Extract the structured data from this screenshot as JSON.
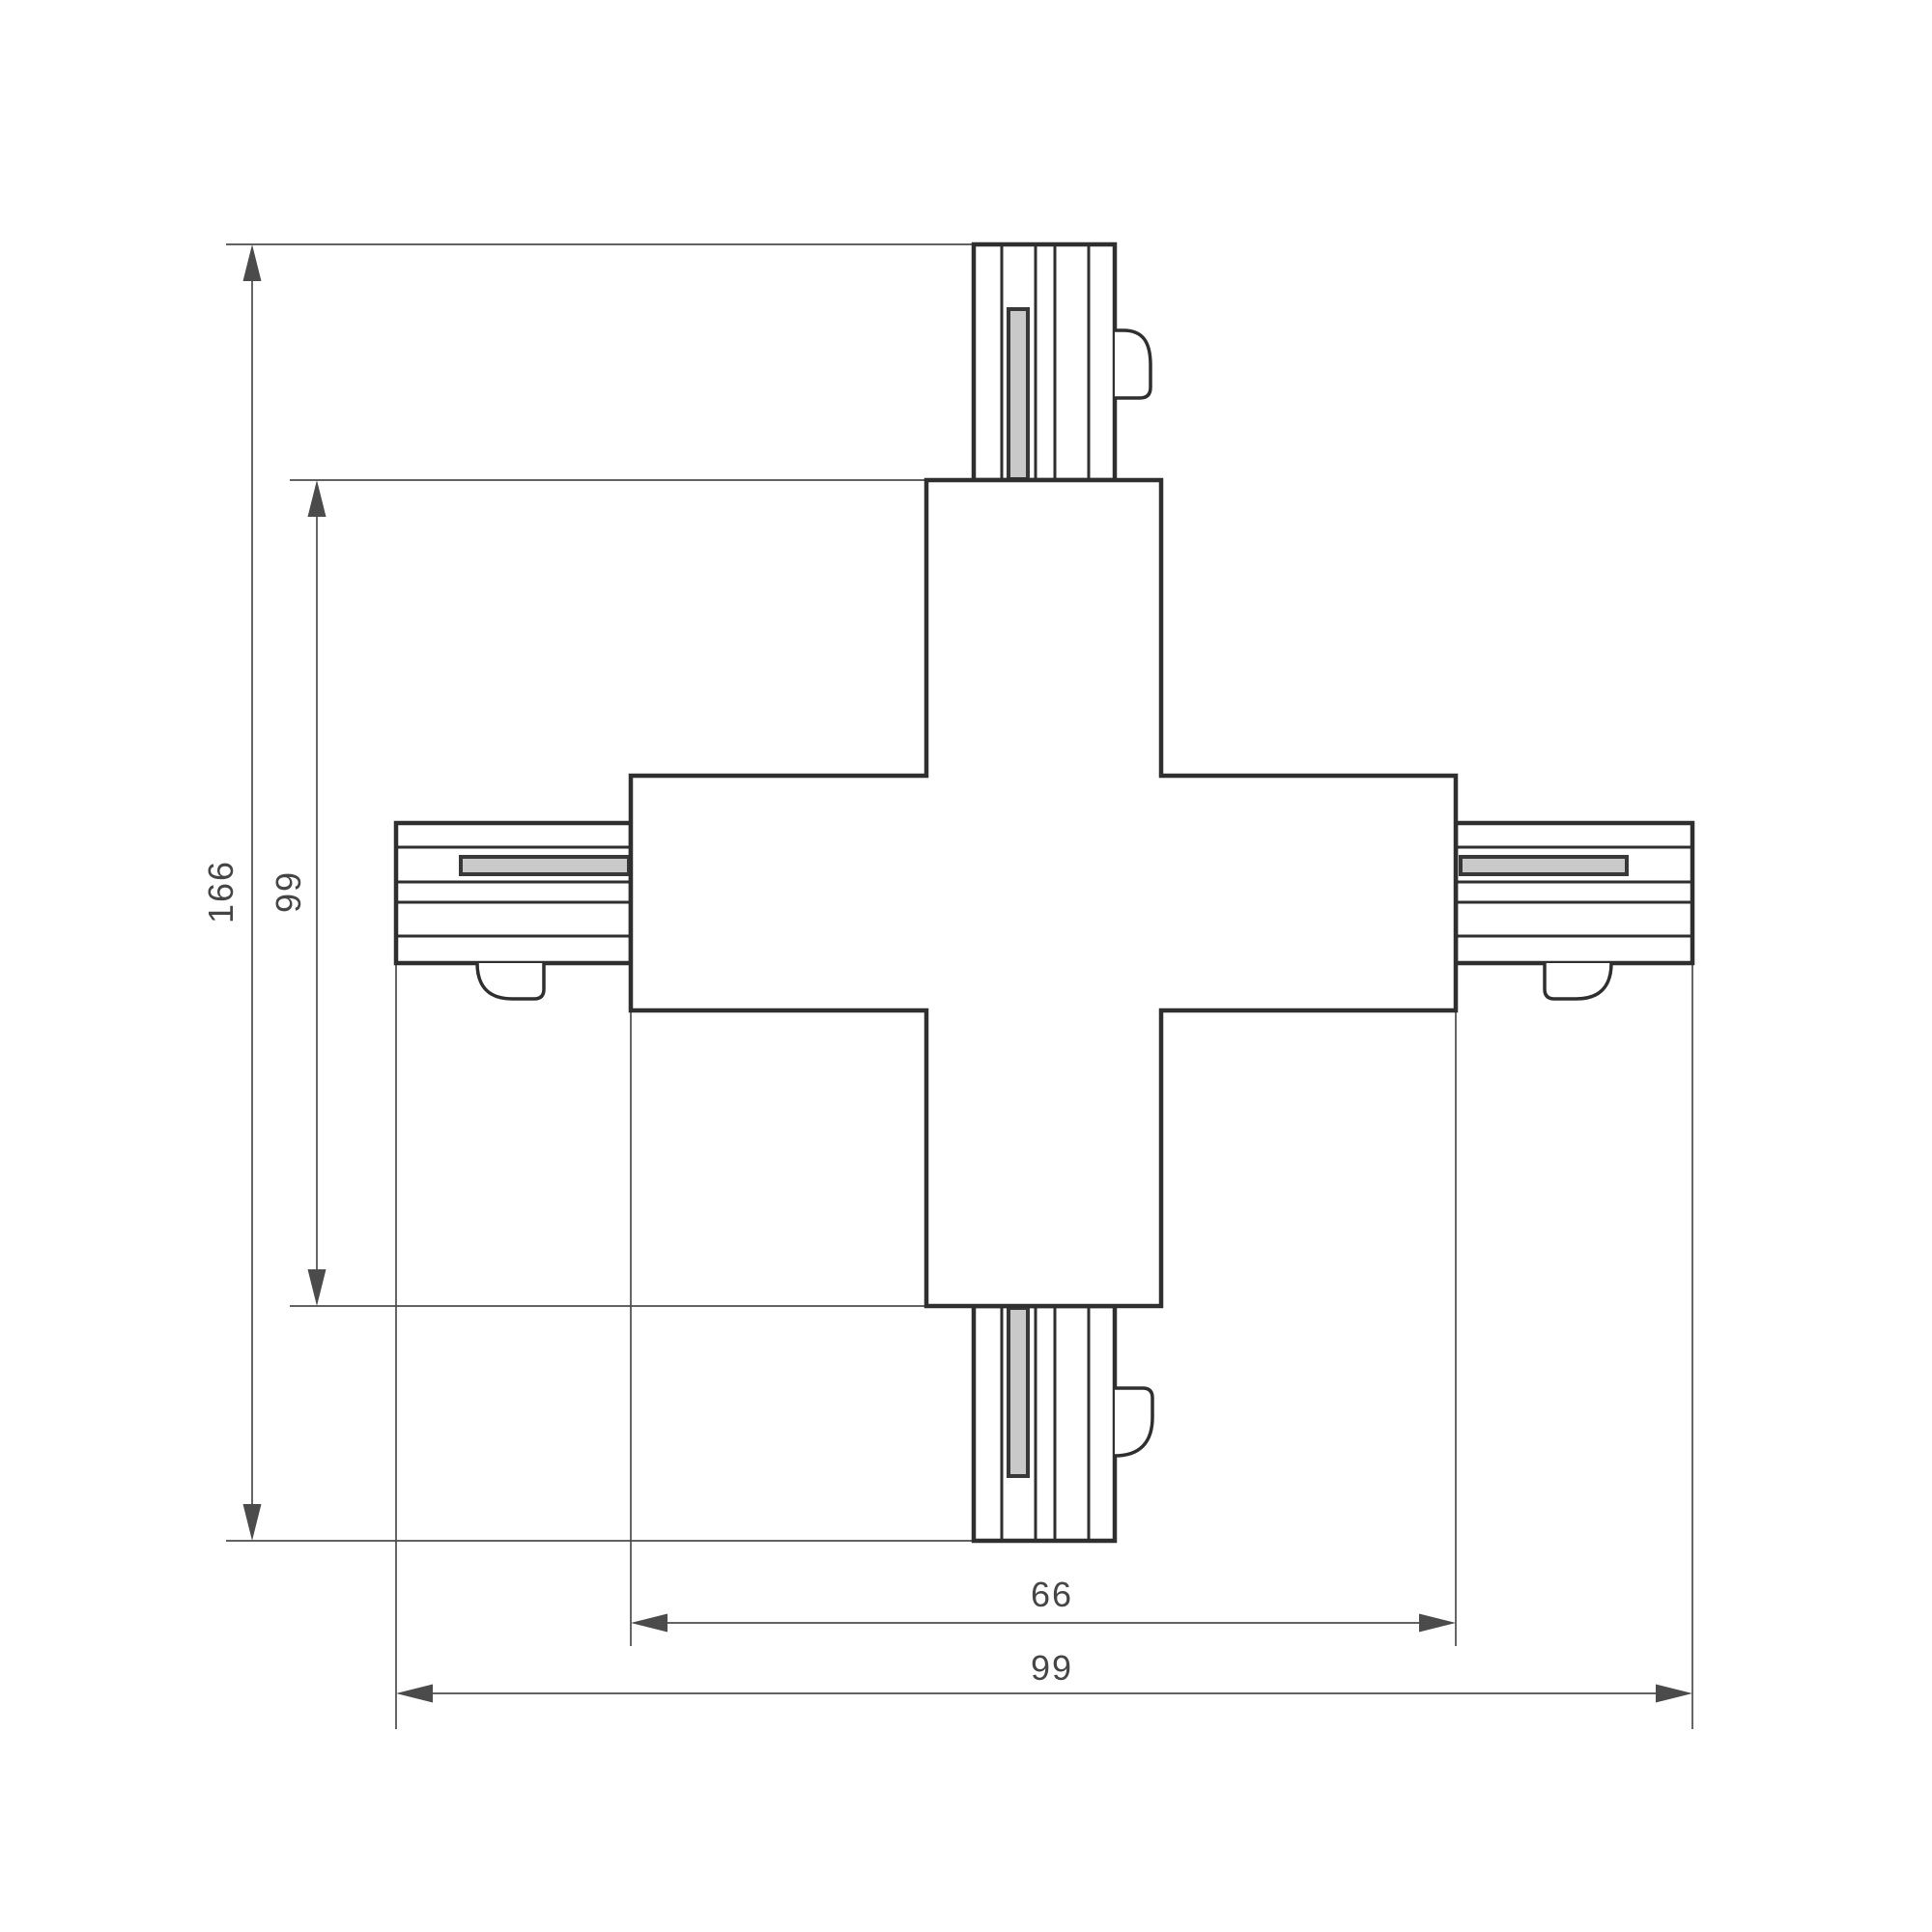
{
  "drawing": {
    "kind": "track X-connector dimension drawing",
    "dimensions": {
      "overall_height": {
        "label": "166"
      },
      "body_height": {
        "label": "99"
      },
      "body_width": {
        "label": "66"
      },
      "overall_width": {
        "label": "99"
      }
    },
    "colors": {
      "background": "#ffffff",
      "outline": "#2f2f2f",
      "fill": "#ffffff",
      "dimension_line": "#4b4b4b",
      "slot_fill": "#c9c9c9",
      "slot_border": "#383838"
    }
  }
}
